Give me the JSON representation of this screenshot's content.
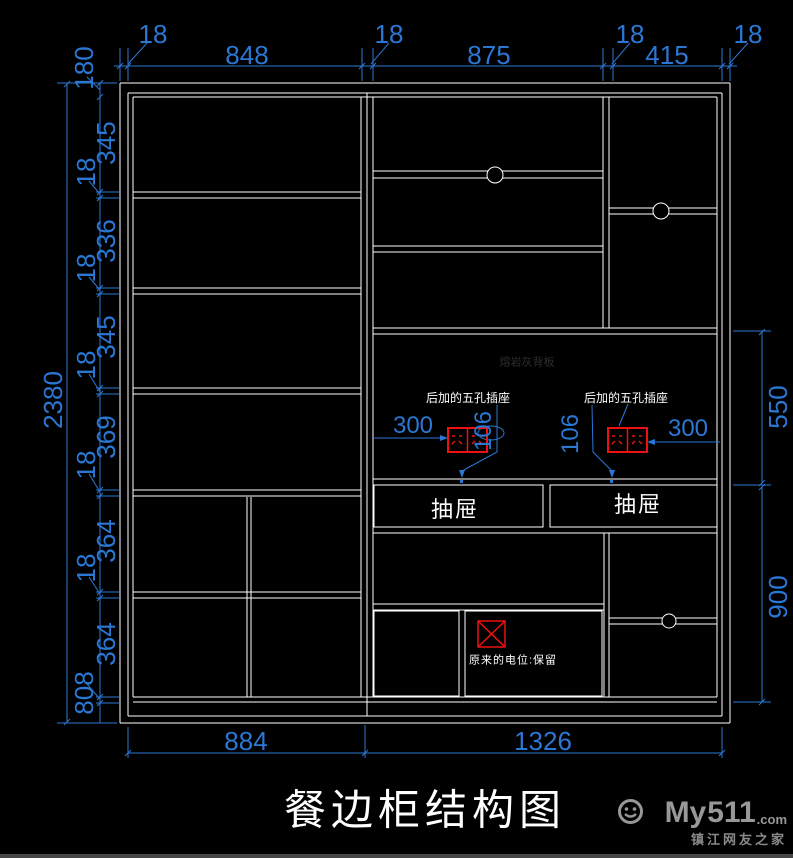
{
  "title": "餐边柜结构图",
  "colors": {
    "background": "#000000",
    "cabinet_line": "#ffffff",
    "dimension": "#2b77d4",
    "socket_red": "#ee1111",
    "faint_note": "#2e2e2e",
    "watermark": "#989898"
  },
  "dims": {
    "top": [
      "18",
      "848",
      "18",
      "875",
      "18",
      "415",
      "18"
    ],
    "left_outer": "2380",
    "left_top": "180",
    "left_chain": [
      "345",
      "18",
      "336",
      "18",
      "345",
      "18",
      "369",
      "18",
      "364",
      "18",
      "364"
    ],
    "left_bottom": "808",
    "right": [
      "550",
      "900"
    ],
    "bottom": [
      "884",
      "1326"
    ]
  },
  "notes": {
    "added_socket_left": "后加的五孔插座",
    "added_socket_right": "后加的五孔插座",
    "socket_offset_left": "300",
    "socket_height_left": "106",
    "socket_height_right": "106",
    "socket_offset_right": "300",
    "drawer_left": "抽屉",
    "drawer_right": "抽屉",
    "back_panel": "熔岩灰背板",
    "keep_outlet": "原来的电位:保留"
  },
  "watermark": {
    "my": "My",
    "num": "511",
    "com": ".com",
    "tagline": "镇江网友之家"
  }
}
